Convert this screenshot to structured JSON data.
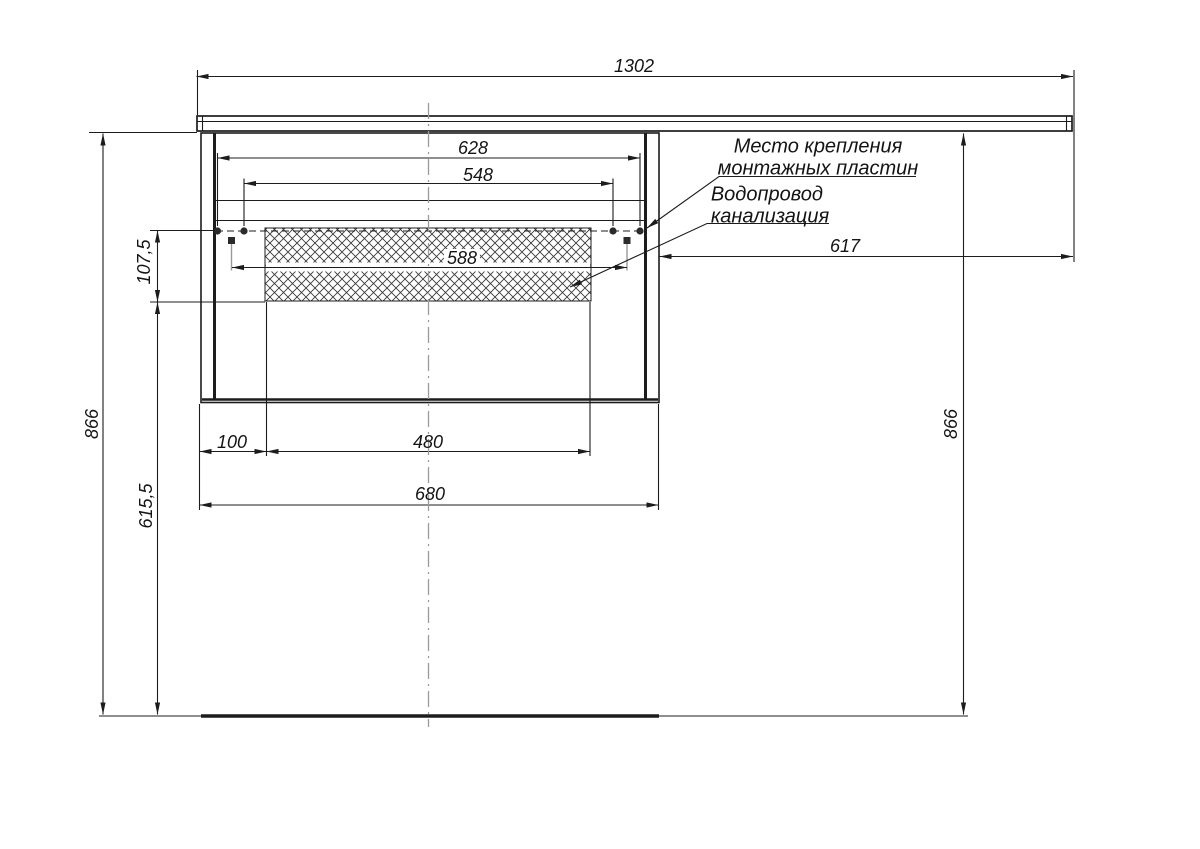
{
  "drawing": {
    "dims": {
      "countertop_width": "1302",
      "mount_outer": "628",
      "mount_inner": "548",
      "cutout_width": "588",
      "right_span": "617",
      "cutout_height": "107,5",
      "height_left": "866",
      "height_right": "866",
      "lower_height": "615,5",
      "bottom_offset": "100",
      "bottom_span": "480",
      "cabinet_width": "680"
    },
    "notes": {
      "mounting_plates_line1": "Место крепления",
      "mounting_plates_line2": "монтажных пластин",
      "plumbing_line1": "Водопровод",
      "plumbing_line2": "канализация"
    },
    "colors": {
      "line": "#1c1c1c",
      "centerline": "#9b9b9b",
      "hatch": "#3a3a3a",
      "background": "#ffffff"
    }
  }
}
